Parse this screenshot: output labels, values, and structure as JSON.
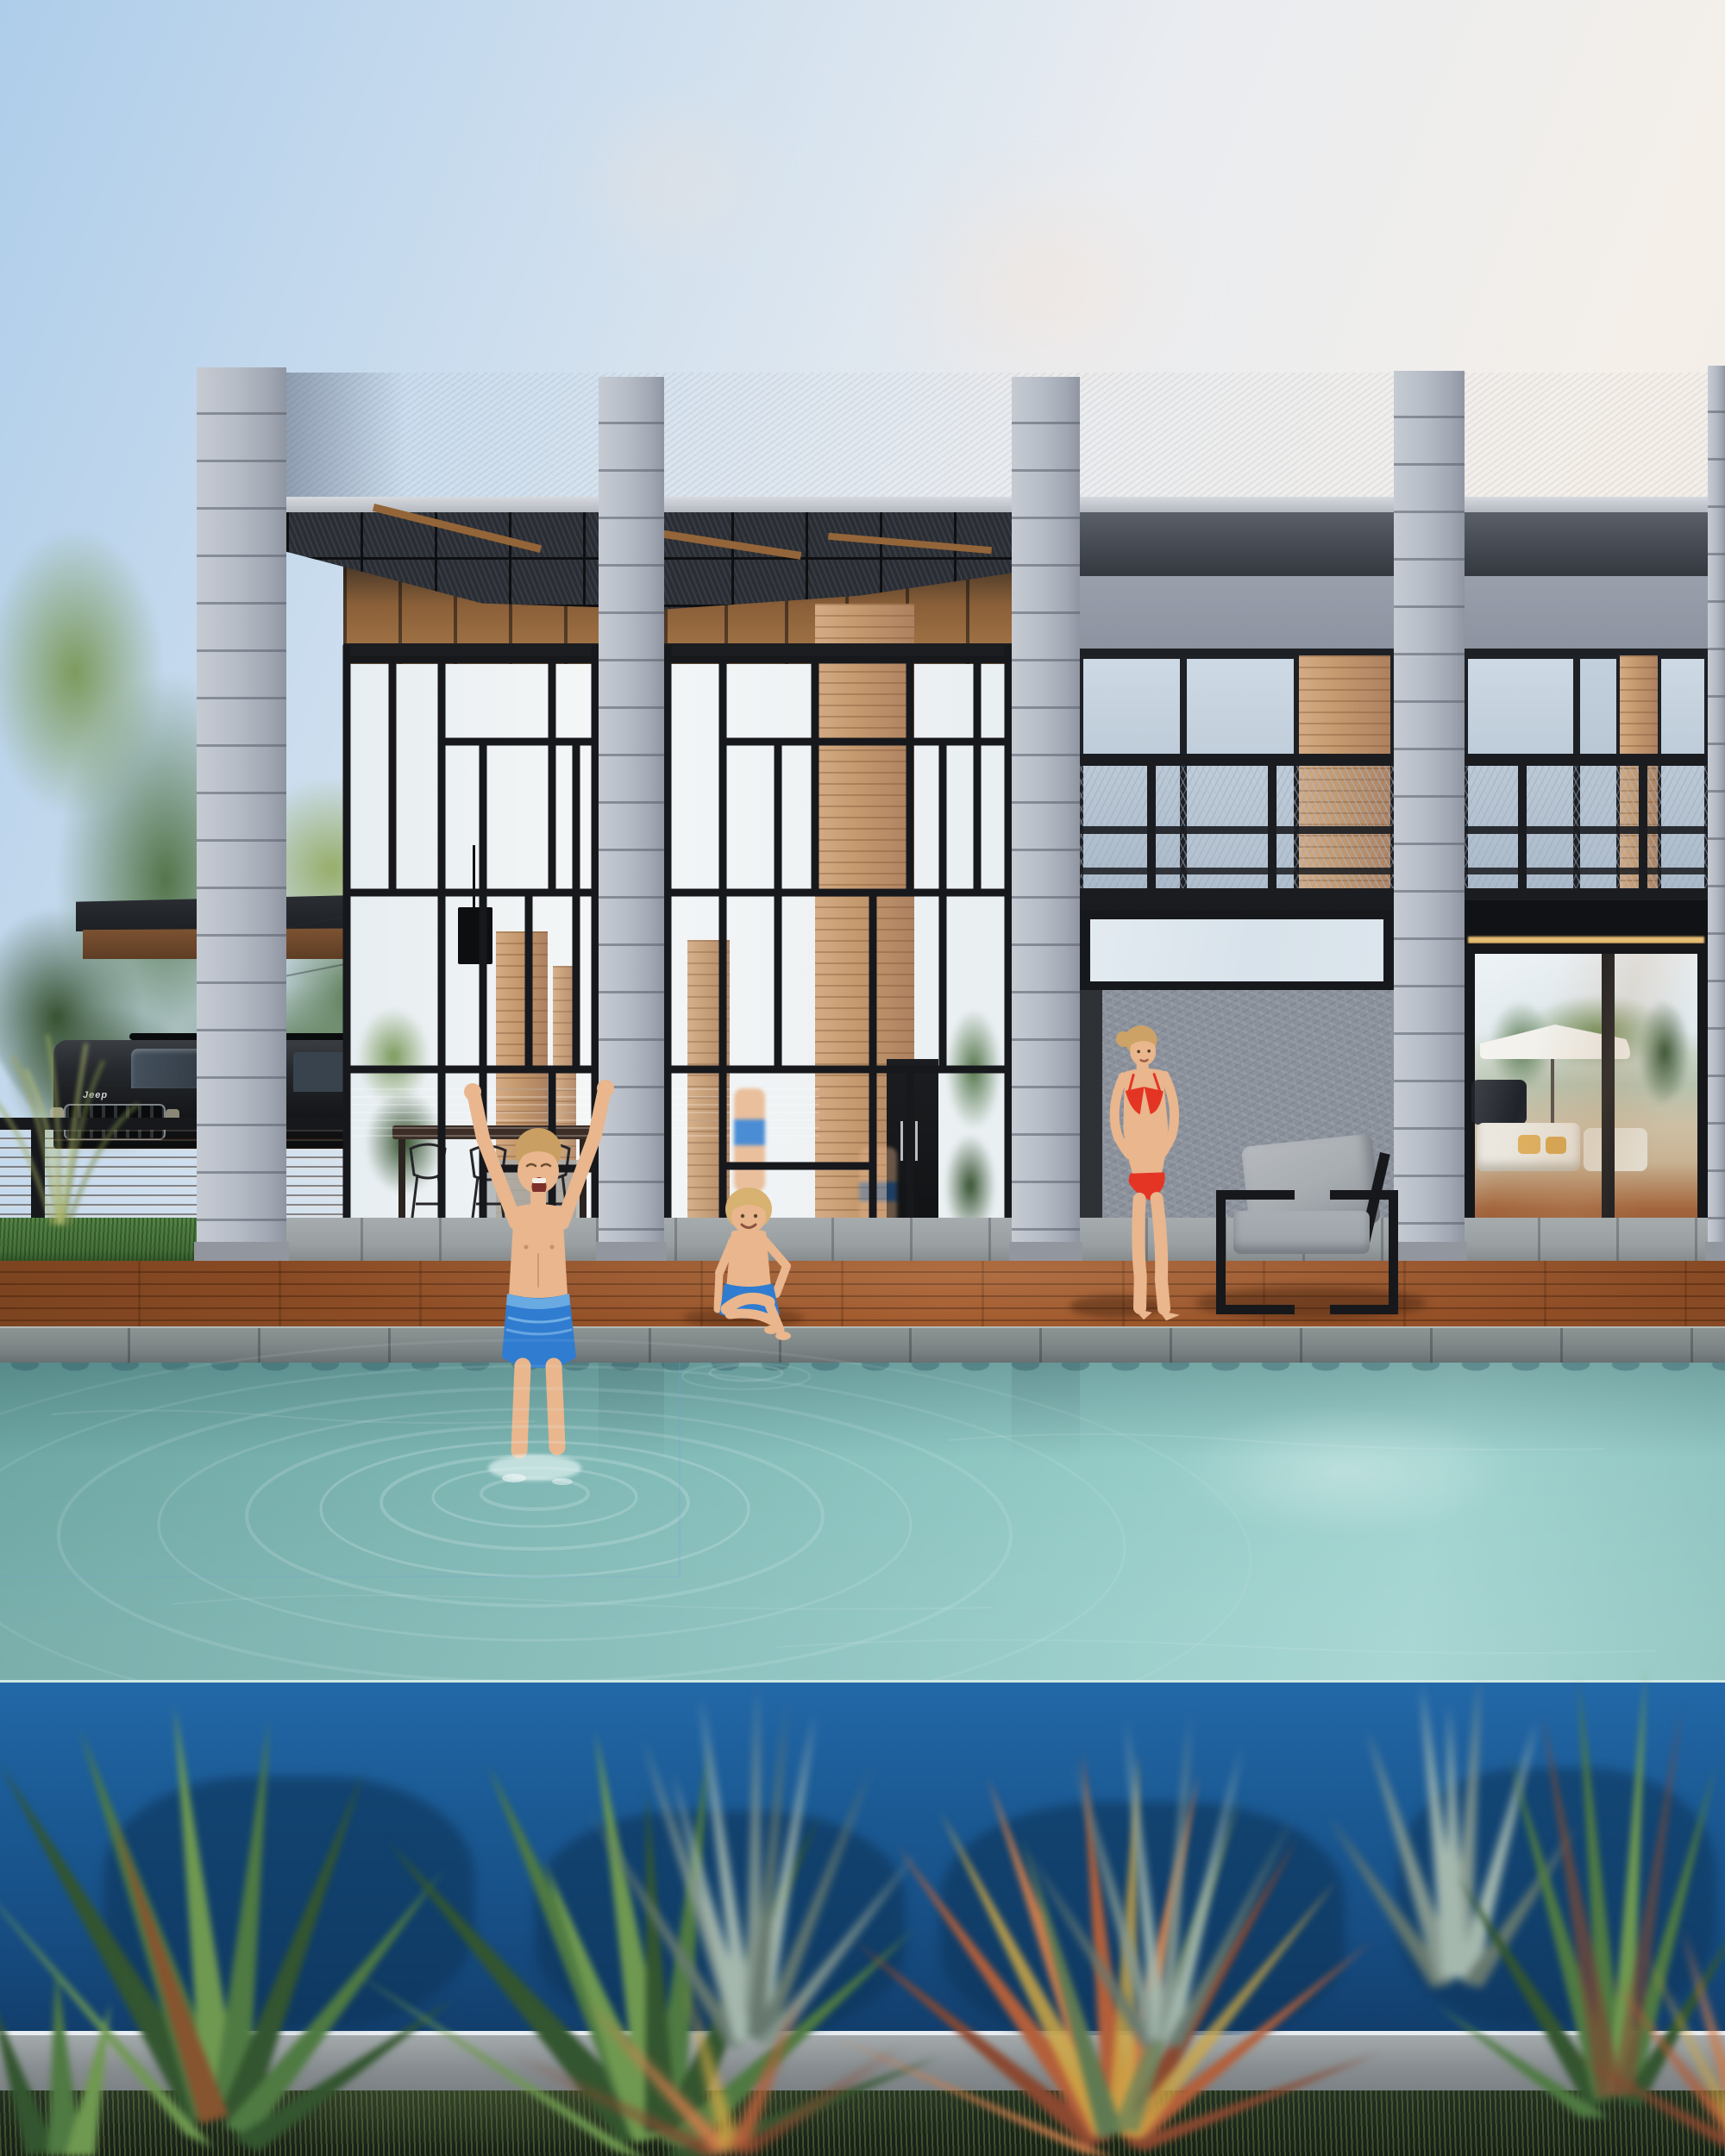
{
  "scene": {
    "title": "Architectural rendering: modern two-storey concrete-and-glass villa with infinity pool, children playing and woman in red bikini on a wooden deck, blurred agave and cordyline plants in the foreground",
    "setting": "dusk exterior visualization",
    "objects": [
      "concrete pillars with horizontal banding",
      "stucco parapet",
      "dark glass pergola roof with wood rafters",
      "double-height steel-framed glass atrium with mondrian mullion pattern",
      "upper floor windows with mesh balcony railings",
      "sky-reflecting transom window",
      "textured concrete wall",
      "sliding glass doors reflecting trees and patio umbrella",
      "carport canopy",
      "black SUV behind wooden slat fence",
      "light pole and cables",
      "dense green trees",
      "hardwood pool deck",
      "stone coping",
      "turquoise pool water with ripples",
      "royal blue infinity pool wall",
      "black steel lounge chair with gray cushions",
      "foreground agave, yucca and red cordyline plants (out of focus)"
    ]
  },
  "vehicle": {
    "badge": "Jeep"
  },
  "figures": {
    "boy": "boy jumping into pool, arms raised, blue swim trunks",
    "child": "young child sitting at pool edge, blue trunks",
    "woman": "woman standing in red bikini on deck"
  },
  "colors": {
    "sky-blue": "#aecdea",
    "sky-pale": "#cfdfee",
    "sky-mid": "#e9ecf0",
    "sky-warm": "#f4efe9",
    "sky-warm2": "#f1ece6",
    "cloud": "#f6e3d5",
    "parapet": "#a6abb9",
    "slab-light": "#d6d9de",
    "slab-dark": "#b3b7bf",
    "pillar": "#b6bcc6",
    "pillar-line": "rgba(88,94,106,0.55)",
    "pillar-base": "#92969f",
    "pergola": "#2a2d33",
    "pergola-line": "#0e0f11",
    "beam-wood": "#946539",
    "interior-wood-dark": "#3a2f24",
    "interior-wood": "#8a5f38",
    "interior-wood-light": "#a8794a",
    "glass-white": "#eef2f4",
    "glass-blue": "#dfe8ee",
    "frame": "#16181c",
    "wood-column": "#c59a6f",
    "atrium-wood": "#c29267",
    "soffit-top": "#5a5f68",
    "soffit-bot": "#34383f",
    "grayband": "#99a0ac",
    "window-glass-top": "#cdd9e4",
    "window-glass-bot": "#a9b9c9",
    "fascia": "#121418",
    "mesh-rail": "#1a1c20",
    "transom-glass": "#d8e2ea",
    "textured-wall": "#8b919b",
    "dark-strip": "#2e3136",
    "led": "#e7bd74",
    "door-glass-sky": "#e9eff3",
    "interior-floor": "#a3653c",
    "umbrella": "#f2f1ec",
    "cushion-white": "#eae6dd",
    "pillow-yellow": "#dfb05e",
    "tree-green": "#53754a",
    "tree-dark": "#35512f",
    "tree-bright": "#7c9a5d",
    "tree-yellow": "#96ad6a",
    "canopy-dark": "#1d2024",
    "canopy-wood": "#7d5332",
    "suv-top": "#3a3e43",
    "suv-body": "#17191c",
    "suv-glass": "#46525e",
    "badge-chrome": "#cfd3d6",
    "fence-wood": "#8a5a36",
    "fence-wood-dark": "#6d452a",
    "grass": "#45703a",
    "walkway": "#9aa0a2",
    "deck": "#96522a",
    "deck-dark": "#7c4420",
    "deck-line": "rgba(55,25,8,0.4)",
    "coping": "#7b8384",
    "coping-light": "#b2b9b7",
    "water-left": "#6ea7a4",
    "water-mid": "#84bcb9",
    "water-right": "#a2d4d0",
    "water-scallop": "rgba(40,80,92,0.5)",
    "ripple": "rgba(230,244,244,0.22)",
    "splash": "rgba(238,250,250,0.6)",
    "bluewall-top": "#2368a8",
    "bluewall": "#1b5a94",
    "bluewall-deep": "#123e6c",
    "wall-shadow": "#0d3458",
    "curb": "#878d90",
    "soil": "#161f15",
    "blade": "rgba(96,116,62,0.55)",
    "plant-green": "#4f7a42",
    "plant-green-light": "#6f9950",
    "plant-green-dark": "#33552f",
    "plant-gray": "#86988f",
    "plant-gray-light": "#a5b8ae",
    "plant-gray-dark": "#67796f",
    "plant-red": "#b35f3a",
    "plant-red-light": "#cd7c4b",
    "plant-red-dark": "#8a4830",
    "plant-stripe": "#d0a845",
    "skin": "#e9b68d",
    "skin-shade": "#c98f68",
    "hair-boy": "#c99f63",
    "hair-child": "#d8b270",
    "hair-woman": "#cda267",
    "trunks": "#2f7cd0",
    "trunks-light": "#69aae2",
    "bikini": "#e43524",
    "chair-frame": "#17181b",
    "chair-cushion": "#a8adb2",
    "chair-seat": "#9ba1a7",
    "shadow-warm": "rgba(45,20,8,0.38)",
    "pole": "#b4b9bd"
  }
}
